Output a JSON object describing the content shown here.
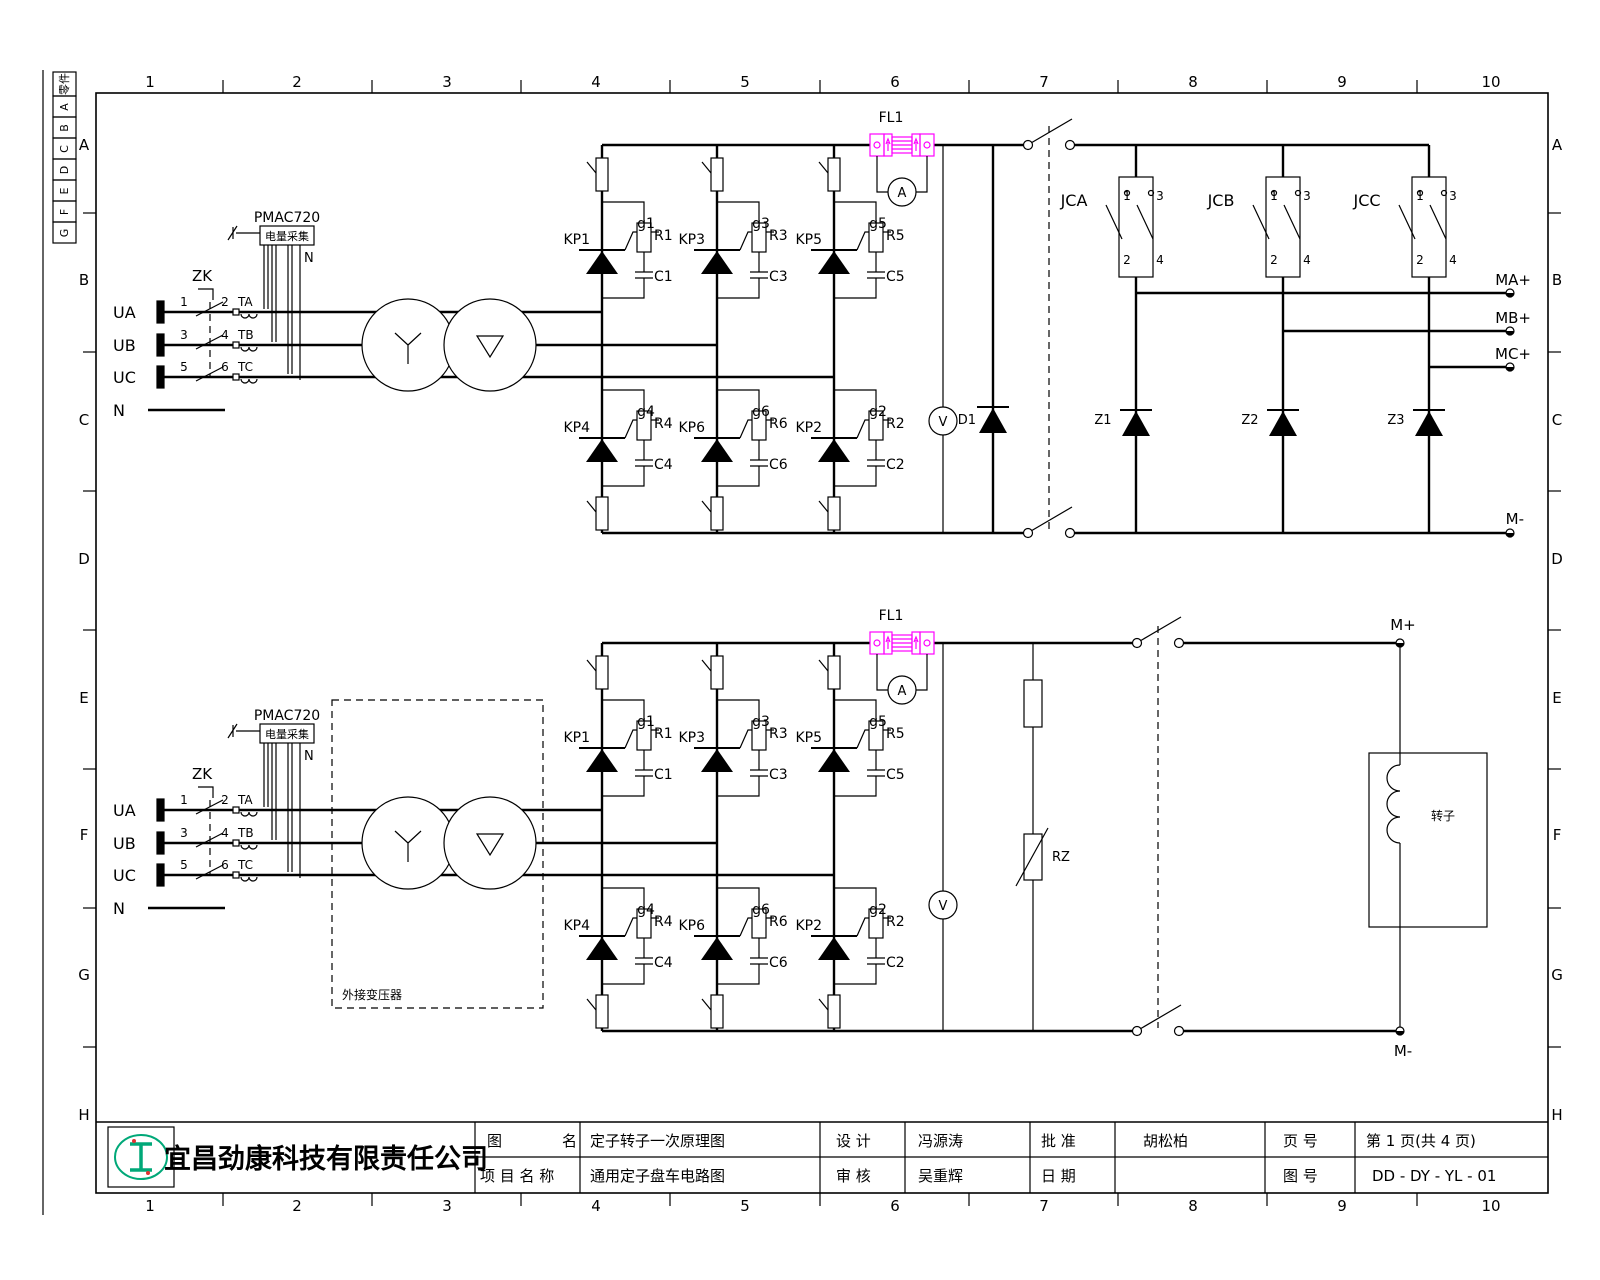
{
  "frame": {
    "cols": [
      "1",
      "2",
      "3",
      "4",
      "5",
      "6",
      "7",
      "8",
      "9",
      "10"
    ],
    "rows": [
      "A",
      "B",
      "C",
      "D",
      "E",
      "F",
      "G",
      "H"
    ],
    "strip": [
      "零件",
      "A",
      "B",
      "C",
      "D",
      "E",
      "F",
      "G"
    ]
  },
  "supply": {
    "phases": [
      "UA",
      "UB",
      "UC"
    ],
    "neutral": "N",
    "breaker": "ZK",
    "contact_numbers": [
      "1",
      "2",
      "3",
      "4",
      "5",
      "6"
    ],
    "cts": [
      "TA",
      "TB",
      "TC"
    ],
    "pmac": {
      "model": "PMAC720",
      "label": "电量采集",
      "neutral": "N"
    }
  },
  "bridge": {
    "upper": [
      {
        "kp": "KP1",
        "g": "g1",
        "r": "R1",
        "c": "C1"
      },
      {
        "kp": "KP3",
        "g": "g3",
        "r": "R3",
        "c": "C3"
      },
      {
        "kp": "KP5",
        "g": "g5",
        "r": "R5",
        "c": "C5"
      }
    ],
    "lower": [
      {
        "kp": "KP4",
        "g": "g4",
        "r": "R4",
        "c": "C4"
      },
      {
        "kp": "KP6",
        "g": "g6",
        "r": "R6",
        "c": "C6"
      },
      {
        "kp": "KP2",
        "g": "g2",
        "r": "R2",
        "c": "C2"
      }
    ]
  },
  "meters": {
    "shunt": "FL1",
    "ammeter": "A",
    "voltmeter": "V"
  },
  "stator": {
    "freewheel_diode": "D1",
    "contactors": [
      {
        "name": "JCA"
      },
      {
        "name": "JCB"
      },
      {
        "name": "JCC"
      }
    ],
    "contact_terminals": [
      "1",
      "3",
      "2",
      "4"
    ],
    "z_diodes": [
      "Z1",
      "Z2",
      "Z3"
    ],
    "outputs": [
      "MA+",
      "MB+",
      "MC+",
      "M-"
    ]
  },
  "rotor": {
    "varistor": "RZ",
    "ext_transformer": "外接变压器",
    "m_plus": "M+",
    "m_minus": "M-",
    "load": "转子"
  },
  "titleblock": {
    "company": "宜昌劲康科技有限责任公司",
    "drawing_label": "图　　　　名",
    "drawing_name": "定子转子一次原理图",
    "project_label": "项 目 名 称",
    "project_name": "通用定子盘车电路图",
    "design_label": "设  计",
    "designer": "冯源涛",
    "check_label": "审  核",
    "checker": "吴重辉",
    "approve_label": "批  准",
    "approver": "胡松柏",
    "date_label": "日  期",
    "date": "",
    "page_label": "页  号",
    "page": "第 1 页(共 4 页)",
    "no_label": "图  号",
    "number": "DD - DY - YL - 01"
  },
  "colors": {
    "line": "#000000",
    "shunt": "#ff00ff",
    "logo": "#00a878",
    "accent": "#e03131"
  }
}
